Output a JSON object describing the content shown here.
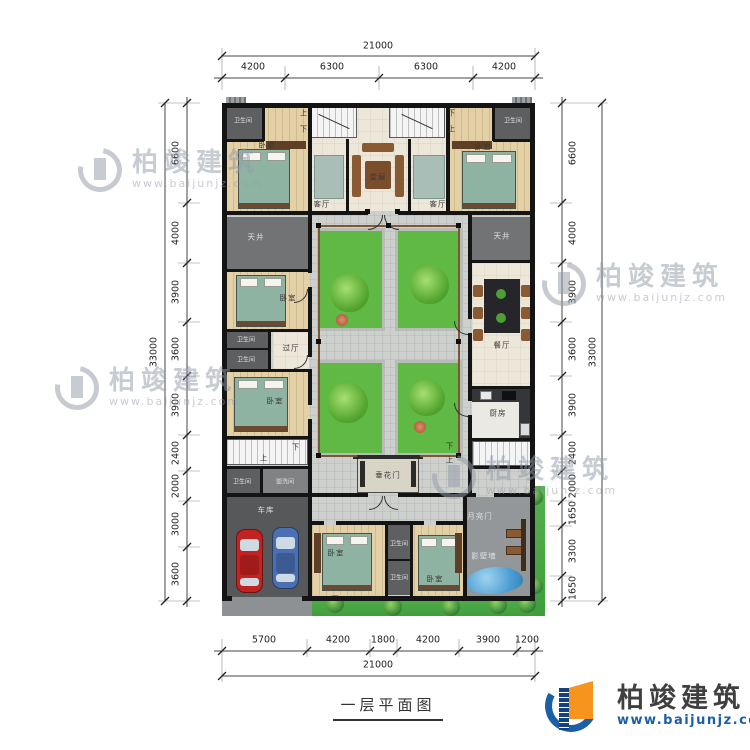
{
  "title": "一层平面图",
  "watermark": {
    "brand": "柏竣建筑",
    "url": "www.baijunjz.com"
  },
  "logo": {
    "brand": "柏竣建筑",
    "url": "www.baijunjz.com"
  },
  "stairs": {
    "up": "上",
    "down": "下"
  },
  "rooms": {
    "bathroom": "卫生间",
    "bedroom": "卧室",
    "living": "客厅",
    "hall": "堂屋",
    "lightwell": "天井",
    "passage": "过厅",
    "dining": "餐厅",
    "kitchen": "厨房",
    "flowerGate": "垂花门",
    "laundry": "盥洗间",
    "garage": "车库",
    "moonGate": "月亮门",
    "screenWall": "影壁墙"
  },
  "dims": {
    "top": {
      "total": "21000",
      "segs": [
        "4200",
        "6300",
        "6300",
        "4200"
      ]
    },
    "bottom": {
      "total": "21000",
      "segs": [
        "5700",
        "4200",
        "1800",
        "4200",
        "3900",
        "1200"
      ]
    },
    "left": {
      "total": "33000",
      "segs": [
        "6600",
        "4000",
        "3900",
        "3600",
        "3900",
        "2400",
        "2000",
        "3000",
        "3600"
      ]
    },
    "right": {
      "total": "33000",
      "segs": [
        "6600",
        "4000",
        "3900",
        "3600",
        "3900",
        "2400",
        "2000",
        "1650",
        "3300",
        "1650"
      ]
    }
  },
  "colors": {
    "wall": "#141414",
    "garden_green": "#5fb944",
    "water": "#4f9fd4",
    "logo_blue": "#1b5fa8",
    "logo_orange": "#f7941d"
  }
}
